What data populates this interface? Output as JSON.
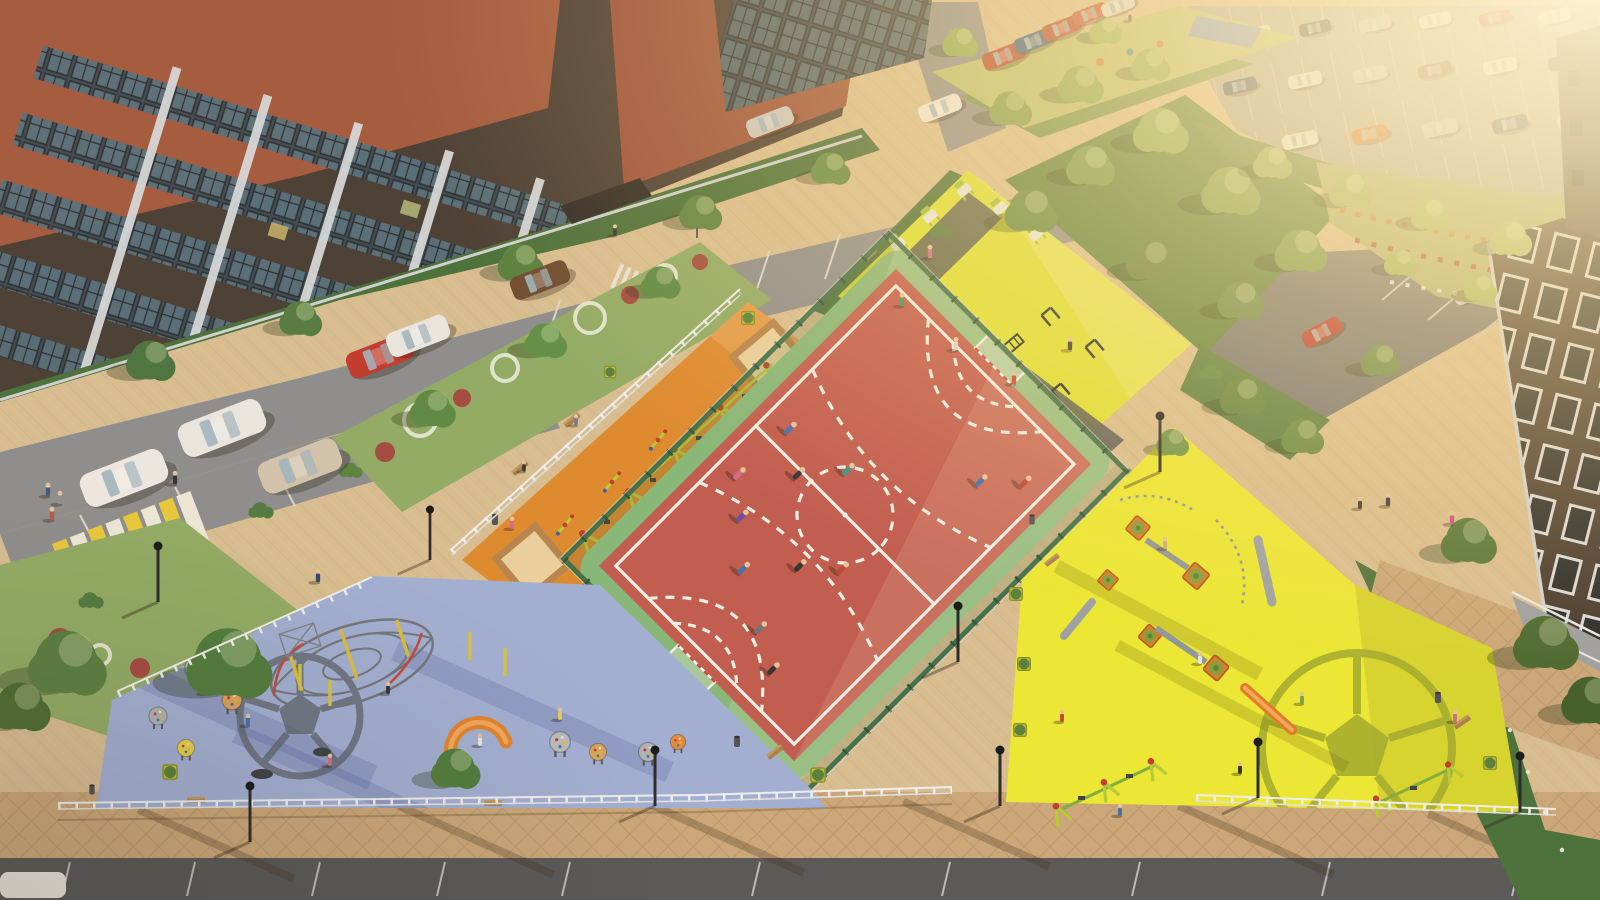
{
  "scene": {
    "type": "aerial-architectural-render",
    "subject": "residential courtyard with mini-football court, four playground zones, street workout area, parking lots, roads and brick apartment buildings",
    "lighting": "warm low sun haze from upper right",
    "camera": "high oblique aerial view"
  },
  "colors": {
    "paver": "#d7bf94",
    "walkway": "#c9a87c",
    "asphalt": "#8b8e90",
    "asphalt_dark": "#54575a",
    "parking_lot": "#a9a89e",
    "parking_lot_right": "#6e7277",
    "court_red": "#c05b51",
    "court_green": "#84b87b",
    "court_line": "#f3f2ec",
    "fence_green": "#3e6f4c",
    "playground_orange": "#dd8a30",
    "playground_blue": "#9fb0d8",
    "playground_yellow": "#ebeb34",
    "workout_yellow": "#dde433",
    "motif_gray": "#59636e",
    "motif_olive": "#a3ad2e",
    "hedge": "#47703b",
    "garden": "#8fac67",
    "lawn": "#b7c173",
    "parterre": "#a8b173",
    "brick_red": "#a2593f",
    "brick_dark": "#473d35",
    "building_dark": "#3f362f",
    "sand": "#ead2a0",
    "wood": "#b5854e",
    "fence_white": "#eef1f2",
    "zebra_yellow": "#e7c93c",
    "marking_white": "#d9d8d2",
    "haze": "#ffedbc"
  },
  "objects": {
    "sports_court": {
      "kind": "mini-football-court",
      "surface": "red rubber",
      "apron": "green rubber",
      "goals": 2,
      "players": 12,
      "markings": [
        "white boundary",
        "halfway line",
        "dashed center circle",
        "dashed penalty arcs"
      ],
      "enclosure": "dark green mesh fence"
    },
    "playground_orange": {
      "surface": "orange rubber",
      "equipment": [
        "a-frame swings",
        "seesaws",
        "two sandboxes",
        "benches",
        "white picket fence"
      ]
    },
    "playground_blue": {
      "surface": "light blue rubber",
      "motif": "soccer ball line art",
      "equipment": [
        "rope climbing dome",
        "climbing pods",
        "orange arc slide",
        "trampolines",
        "benches"
      ]
    },
    "playground_yellow": {
      "surface": "bright yellow rubber",
      "motif": "soccer ball line art",
      "equipment": [
        "wooden play towers with slides",
        "two swing sets",
        "benches",
        "planter cubes"
      ]
    },
    "workout_zone": {
      "surface": "yellow-green rubber with dark paths",
      "equipment": [
        "pull-up bars",
        "parallel bars",
        "monkey bars",
        "green exercise machines"
      ]
    },
    "parking": {
      "street_parking_cars": 13,
      "top_right_lot_cars": 17,
      "small_right_lot_cars": 2
    },
    "roads": {
      "zebra_crossings": 2,
      "speed_bump": true,
      "crosswalk_sign": true
    },
    "buildings": [
      "brick apartment top-left",
      "brick apartment top-center",
      "brick apartment right",
      "far-right sliver"
    ],
    "landscape": [
      "hedges",
      "flower parterre",
      "flower swirl beds",
      "lawns",
      "trees"
    ],
    "street_furniture": [
      "street lamps",
      "benches",
      "litter bins",
      "planter cubes",
      "white rail fences"
    ],
    "people_estimate": 40
  }
}
